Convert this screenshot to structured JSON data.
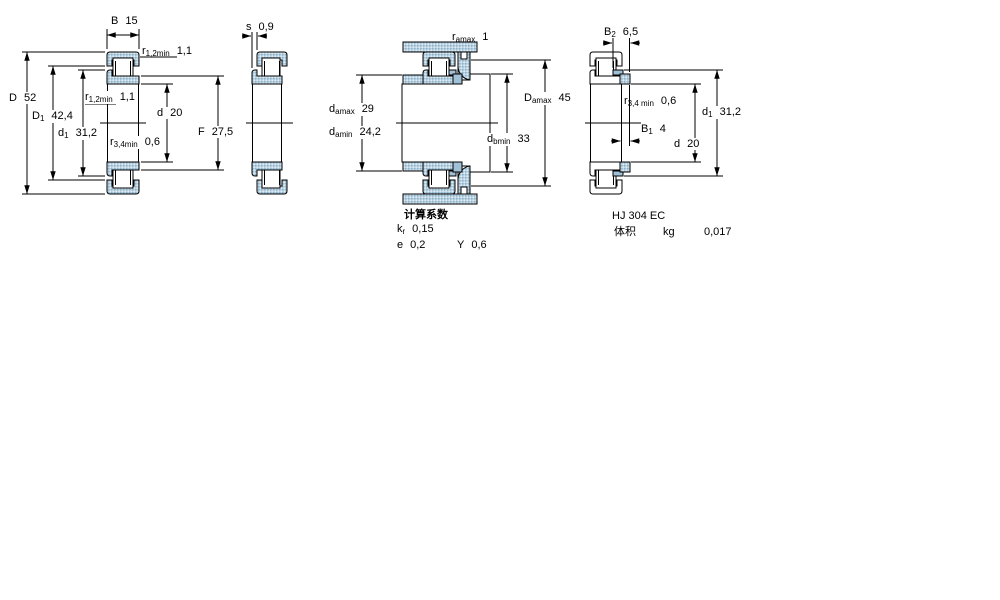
{
  "drawing": {
    "background": "#ffffff",
    "line_color": "#000000",
    "ring_fill": "#b9d2e2",
    "ring_dot_color": "#8fb2cb",
    "solid_ring_fill": "#9fc0d6",
    "fig1": {
      "b": {
        "sym": "B",
        "val": "15"
      },
      "r12_top": {
        "sym": "r",
        "sub": "1,2min",
        "val": "1,1"
      },
      "D": {
        "sym": "D",
        "val": "52"
      },
      "D1": {
        "sym": "D",
        "sub": "1",
        "val": "42,4"
      },
      "d1": {
        "sym": "d",
        "sub": "1",
        "val": "31,2"
      },
      "r12_mid": {
        "sym": "r",
        "sub": "1,2min",
        "val": "1,1"
      },
      "d": {
        "sym": "d",
        "val": "20"
      },
      "F": {
        "sym": "F",
        "val": "27,5"
      },
      "r34": {
        "sym": "r",
        "sub": "3,4min",
        "val": "0,6"
      }
    },
    "fig2": {
      "s": {
        "sym": "s",
        "val": "0,9"
      }
    },
    "fig3": {
      "ra": {
        "sym": "r",
        "sub": "amax",
        "val": "1"
      },
      "da_max": {
        "sym": "d",
        "sub": "amax",
        "val": "29"
      },
      "da_min": {
        "sym": "d",
        "sub": "amin",
        "val": "24,2"
      },
      "Da_max": {
        "sym": "D",
        "sub": "amax",
        "val": "45"
      },
      "db_min": {
        "sym": "d",
        "sub": "bmin",
        "val": "33"
      }
    },
    "fig4": {
      "B2": {
        "sym": "B",
        "sub": "2",
        "val": "6,5"
      },
      "r34": {
        "sym": "r",
        "sub": "3,4 min",
        "val": "0,6"
      },
      "B1": {
        "sym": "B",
        "sub": "1",
        "val": "4"
      },
      "d": {
        "sym": "d",
        "val": "20"
      },
      "d1": {
        "sym": "d",
        "sub": "1",
        "val": "31,2"
      }
    },
    "calc": {
      "title": "计算系数",
      "kr": {
        "sym": "k",
        "sub": "r",
        "val": "0,15"
      },
      "e": {
        "sym": "e",
        "val": "0,2"
      },
      "Y": {
        "sym": "Y",
        "val": "0,6"
      }
    },
    "hj": {
      "designation": "HJ 304 EC",
      "mass_label": "体积",
      "mass_unit": "kg",
      "mass_value": "0,017"
    }
  }
}
